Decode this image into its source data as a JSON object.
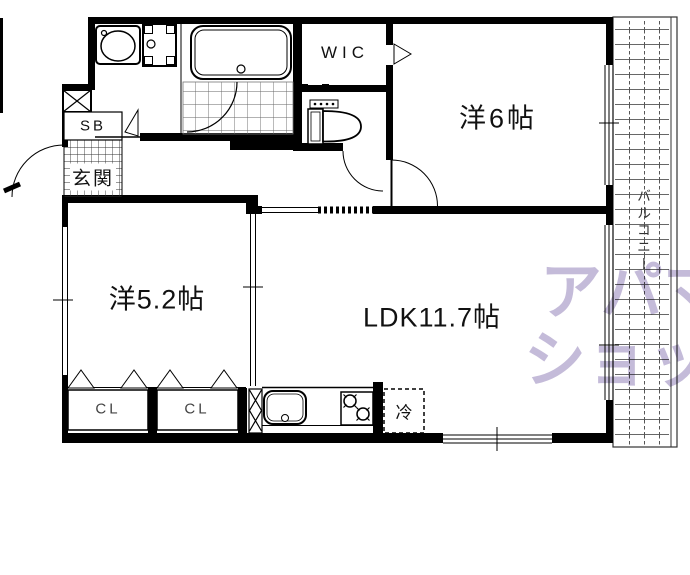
{
  "floorplan": {
    "labels": {
      "shoe_box": "SB",
      "entrance": "玄関",
      "walk_in_closet": "WIC",
      "western_room_6": "洋6帖",
      "western_room_52": "洋5.2帖",
      "ldk": "LDK11.7帖",
      "closet_left": "CL",
      "closet_right": "CL",
      "refrigerator": "冷",
      "balcony": "バルコニー"
    },
    "watermark": {
      "line1": "アパマン",
      "line2": "ショップ",
      "color": "#a091c1"
    },
    "colors": {
      "wall": "#000000",
      "background": "#ffffff",
      "tile_grid": "#555555"
    }
  }
}
